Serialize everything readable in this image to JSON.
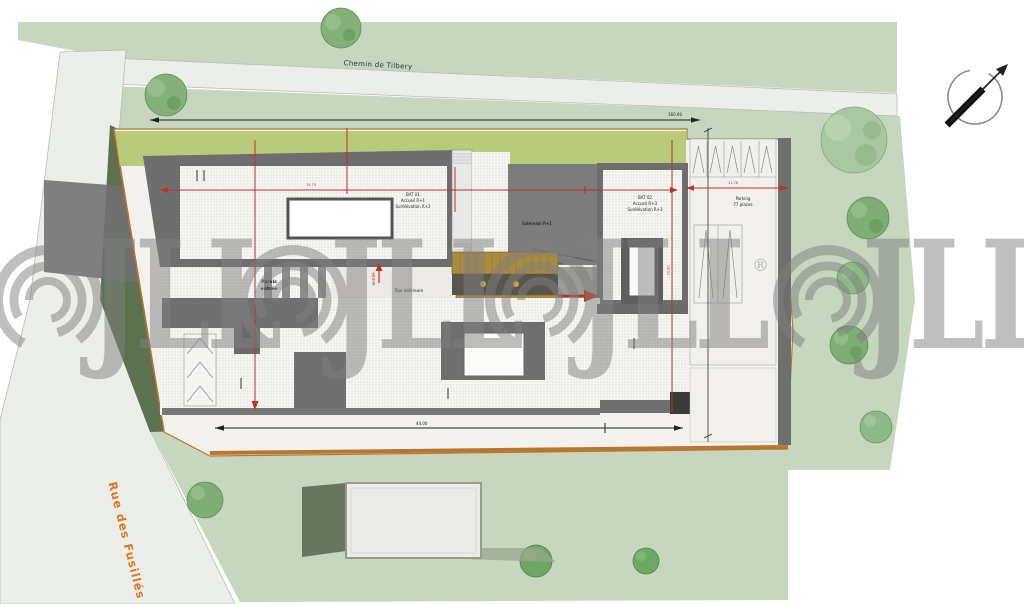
{
  "streets": {
    "top_road": "Chemin de Tilbery",
    "left_road": "Rue des Fusillés"
  },
  "buildings": {
    "bat01": {
      "line1": "BAT 01",
      "line2": "Accueil R+1",
      "line3": "Surélévation R+2"
    },
    "bat02": {
      "line1": "BAT 02",
      "line2": "Accueil R+3",
      "line3": "Surélévation R+3"
    },
    "extension": "Extension R+1",
    "parking": {
      "line1": "Parking",
      "line2": "77 places"
    },
    "parvis": {
      "line1": "Parvis",
      "line2": "entrée"
    },
    "rue_interieure": "Rue intérieure"
  },
  "annotations": {
    "entry_left": "entrée",
    "entry_right": "entrée"
  },
  "dimensions": {
    "top_total": "160.00",
    "bottom_total": "44.00",
    "site_width": "15.75",
    "parking_width": "11.78",
    "site_height": "70.00"
  },
  "watermark": {
    "brand": "JLL",
    "registered": "®"
  },
  "colors": {
    "grass": "#c6d6bf",
    "lawn_strip": "#b9cb7a",
    "road": "#eceeea",
    "roof_dark": "#6e6e6e",
    "boundary": "#b7772e",
    "dimension_red": "#c03027",
    "watermark_gray": "#808080",
    "street_label_orange": "#e0761f"
  }
}
